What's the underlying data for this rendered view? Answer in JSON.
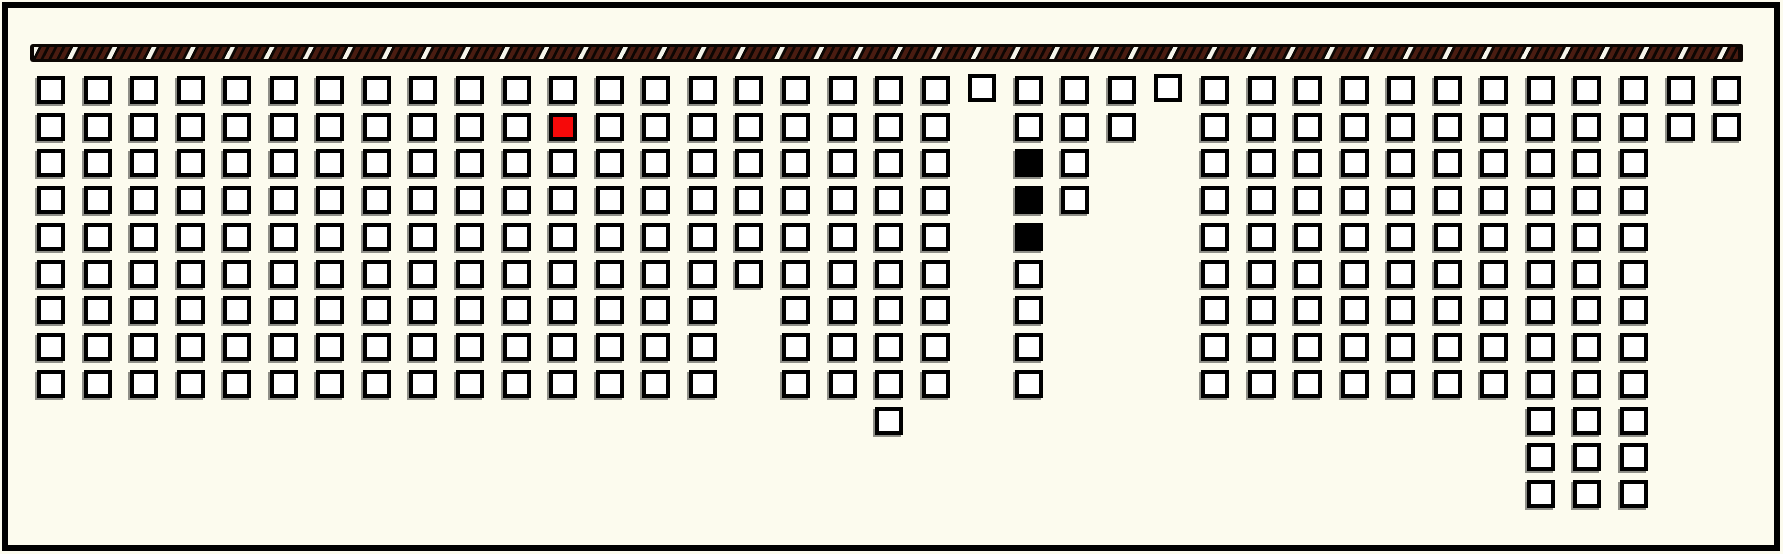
{
  "colors": {
    "background": "#fcfbee",
    "frame": "#000000",
    "seat_fill": "#ffffff",
    "seat_border": "#000000",
    "seat_shadow": "#8f8f88",
    "seat_selected": "#f60909",
    "seat_occupied": "#000000",
    "bar_base": "#0c0603",
    "bar_stripe": "#4a1c11",
    "bar_stripe_alt": "#f5f4ea"
  },
  "stage_bar": {
    "x": 30,
    "y": 44,
    "width": 1713,
    "height": 18,
    "stripe_angle_deg": 117,
    "stripe_period_px": 35,
    "pattern": "four dark-brown diagonal stripes then one white diagonal stripe, repeating on black"
  },
  "grid": {
    "columns": 37,
    "rows": 12,
    "origin_x": 37,
    "origin_y": 76,
    "pitch_x": 46.56,
    "pitch_y": 36.73,
    "seat_outer_px": 28,
    "raised_offset_px": -2,
    "rows_spec": [
      {
        "row": 1,
        "present": [
          [
            1,
            37
          ]
        ],
        "raised": [
          21,
          25
        ]
      },
      {
        "row": 2,
        "present": [
          [
            1,
            20
          ],
          [
            22,
            24
          ],
          [
            26,
            37
          ]
        ],
        "selected": [
          12
        ]
      },
      {
        "row": 3,
        "present": [
          [
            1,
            20
          ],
          [
            22,
            23
          ],
          [
            26,
            35
          ]
        ],
        "occupied": [
          22
        ]
      },
      {
        "row": 4,
        "present": [
          [
            1,
            20
          ],
          [
            22,
            23
          ],
          [
            26,
            35
          ]
        ],
        "occupied": [
          22
        ]
      },
      {
        "row": 5,
        "present": [
          [
            1,
            20
          ],
          [
            22,
            22
          ],
          [
            26,
            35
          ]
        ],
        "occupied": [
          22
        ]
      },
      {
        "row": 6,
        "present": [
          [
            1,
            20
          ],
          [
            22,
            22
          ],
          [
            26,
            35
          ]
        ]
      },
      {
        "row": 7,
        "present": [
          [
            1,
            15
          ],
          [
            17,
            20
          ],
          [
            22,
            22
          ],
          [
            26,
            35
          ]
        ]
      },
      {
        "row": 8,
        "present": [
          [
            1,
            15
          ],
          [
            17,
            20
          ],
          [
            22,
            22
          ],
          [
            26,
            35
          ]
        ]
      },
      {
        "row": 9,
        "present": [
          [
            1,
            15
          ],
          [
            17,
            20
          ],
          [
            22,
            22
          ],
          [
            26,
            35
          ]
        ]
      },
      {
        "row": 10,
        "present": [
          [
            19,
            19
          ],
          [
            33,
            35
          ]
        ]
      },
      {
        "row": 11,
        "present": [
          [
            33,
            35
          ]
        ]
      },
      {
        "row": 12,
        "present": [
          [
            33,
            35
          ]
        ]
      }
    ],
    "counts": {
      "total_squares": 298,
      "white_available": 294,
      "black_occupied": 3,
      "red_selected": 1
    },
    "states": {
      "available": "white square",
      "selected": "red square (row 2, col 12)",
      "occupied": "black squares (rows 3-5, col 22)"
    }
  }
}
